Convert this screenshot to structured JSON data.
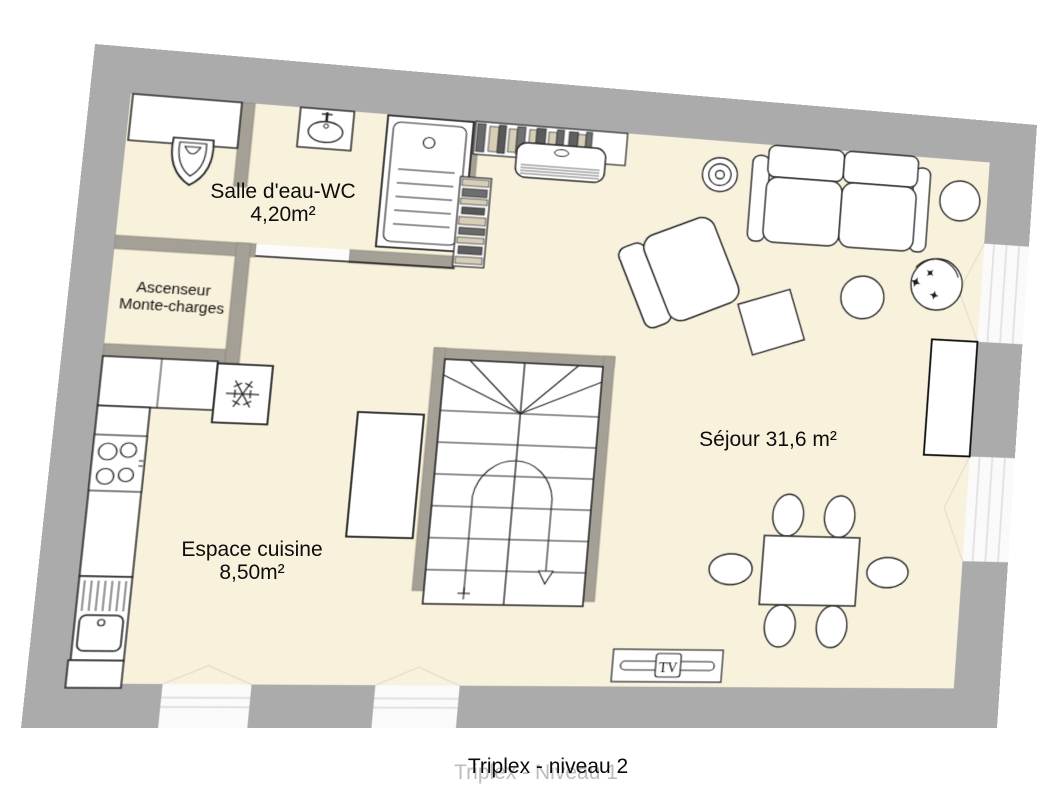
{
  "title": {
    "main": "Triplex - niveau 2",
    "ghost": "Triplex - Niveau 1"
  },
  "rooms": {
    "bathroom": {
      "name": "Salle d'eau-WC",
      "area": "4,20m²"
    },
    "elevator": {
      "line1": "Ascenseur",
      "line2": "Monte-charges"
    },
    "kitchen": {
      "name": "Espace cuisine",
      "area": "8,50m²"
    },
    "living": {
      "name": "Séjour 31,6 m²"
    }
  },
  "furniture_labels": {
    "tv": "TV"
  },
  "colors": {
    "outer_wall": "#ABABAB",
    "partition_wall": "#A5A096",
    "floor": "#F8F1DB",
    "furniture_outline": "#222222",
    "furniture_fill": "#FFFFFF",
    "book_tan": "#D7CEB8",
    "book_gray": "#6A6A6A",
    "window_white": "#FAFAFA",
    "ghost_text": "#BCBCBC",
    "label_text": "#0D0D0D"
  }
}
